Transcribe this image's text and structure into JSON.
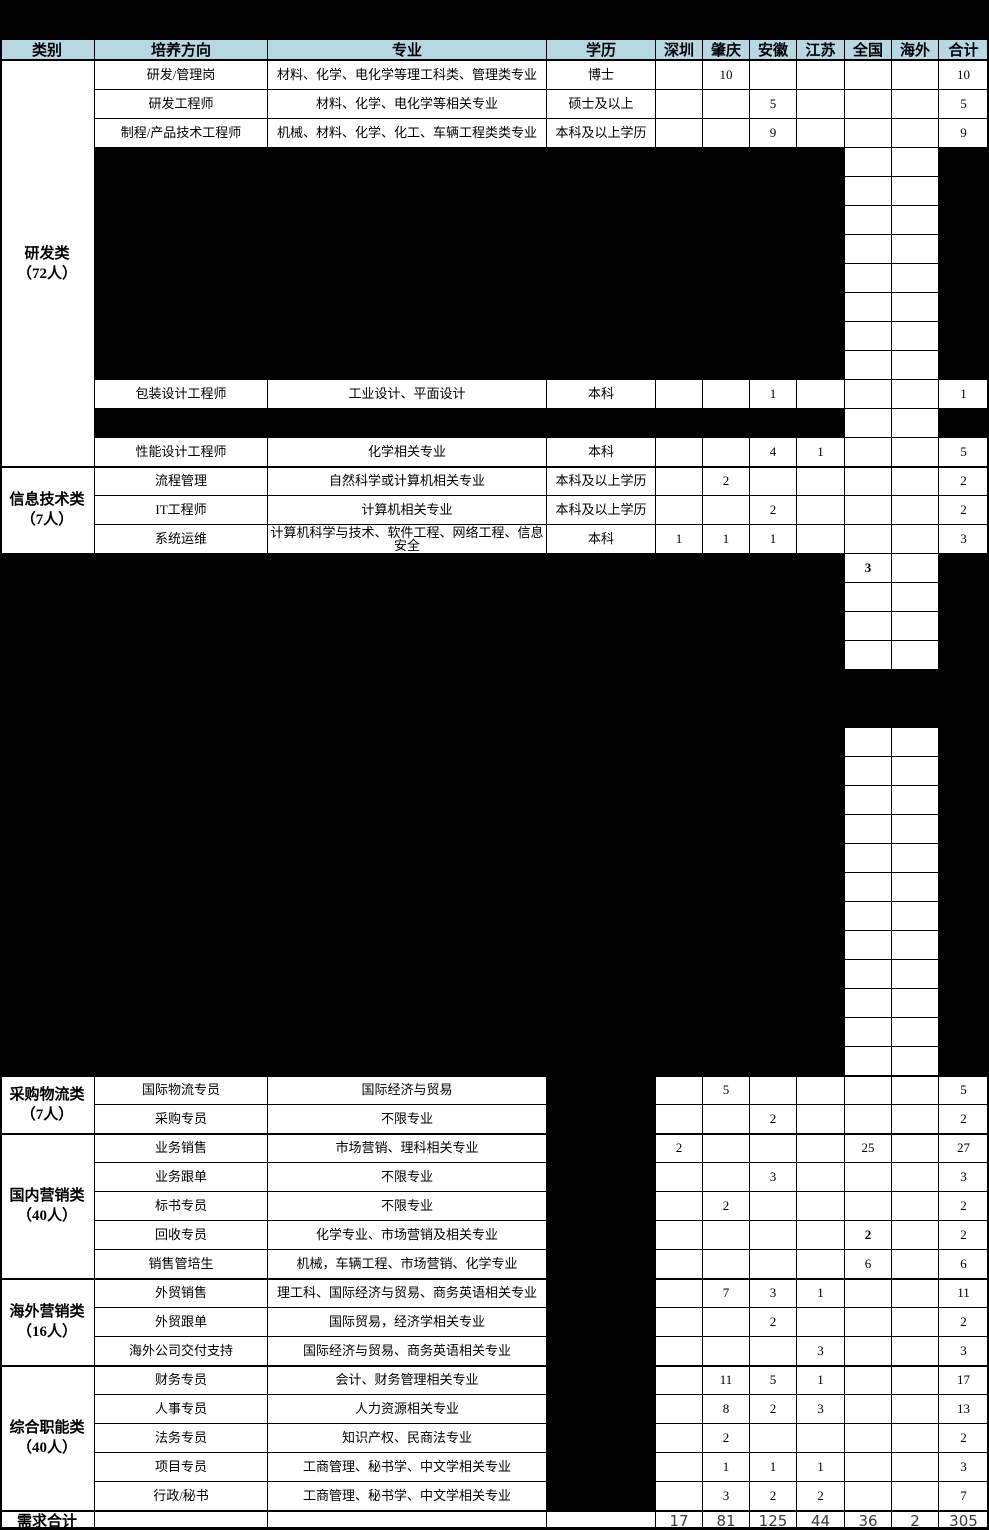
{
  "header": {
    "columns": [
      "类别",
      "培养方向",
      "专业",
      "学历",
      "深圳",
      "肇庆",
      "安徽",
      "江苏",
      "全国",
      "海外",
      "合计"
    ]
  },
  "sections": [
    {
      "category": "研发类\n（72人）",
      "rows": [
        {
          "direction": "研发/管理岗",
          "major": "材料、化学、电化学等理工科类、管理类专业",
          "degree": "博士",
          "values": [
            "",
            "10",
            "",
            "",
            "",
            "",
            "10"
          ]
        },
        {
          "direction": "研发工程师",
          "major": "材料、化学、电化学等相关专业",
          "degree": "硕士及以上",
          "values": [
            "",
            "",
            "5",
            "",
            "",
            "",
            "5"
          ]
        },
        {
          "direction": "制程/产品技术工程师",
          "major": "机械、材料、化学、化工、车辆工程类类专业",
          "degree": "本科及以上学历",
          "values": [
            "",
            "",
            "9",
            "",
            "",
            "",
            "9"
          ]
        },
        {
          "direction": "包装设计工程师",
          "major": "工业设计、平面设计",
          "degree": "本科",
          "values": [
            "",
            "",
            "1",
            "",
            "",
            "",
            "1"
          ]
        },
        {
          "direction": "性能设计工程师",
          "major": "化学相关专业",
          "degree": "本科",
          "values": [
            "",
            "",
            "4",
            "1",
            "",
            "",
            "5"
          ]
        }
      ]
    },
    {
      "category": "信息技术类\n（7人）",
      "rows": [
        {
          "direction": "流程管理",
          "major": "自然科学或计算机相关专业",
          "degree": "本科及以上学历",
          "values": [
            "",
            "2",
            "",
            "",
            "",
            "",
            "2"
          ]
        },
        {
          "direction": "IT工程师",
          "major": "计算机相关专业",
          "degree": "本科及以上学历",
          "values": [
            "",
            "",
            "2",
            "",
            "",
            "",
            "2"
          ]
        },
        {
          "direction": "系统运维",
          "major": "计算机科学与技术、软件工程、网络工程、信息安全",
          "degree": "本科",
          "values": [
            "1",
            "1",
            "1",
            "",
            "",
            "",
            "3"
          ]
        }
      ]
    },
    {
      "category": "采购物流类\n（7人）",
      "rows": [
        {
          "direction": "国际物流专员",
          "major": "国际经济与贸易",
          "degree": "",
          "values": [
            "",
            "5",
            "",
            "",
            "",
            "",
            "5"
          ]
        },
        {
          "direction": "采购专员",
          "major": "不限专业",
          "degree": "",
          "values": [
            "",
            "",
            "2",
            "",
            "",
            "",
            "2"
          ]
        }
      ]
    },
    {
      "category": "国内营销类\n（40人）",
      "rows": [
        {
          "direction": "业务销售",
          "major": "市场营销、理科相关专业",
          "degree": "",
          "values": [
            "2",
            "",
            "",
            "",
            "25",
            "",
            "27"
          ]
        },
        {
          "direction": "业务跟单",
          "major": "不限专业",
          "degree": "",
          "values": [
            "",
            "",
            "3",
            "",
            "",
            "",
            "3"
          ]
        },
        {
          "direction": "标书专员",
          "major": "不限专业",
          "degree": "",
          "values": [
            "",
            "2",
            "",
            "",
            "",
            "",
            "2"
          ]
        },
        {
          "direction": "回收专员",
          "major": "化学专业、市场营销及相关专业",
          "degree": "",
          "values": [
            "",
            "",
            "",
            "",
            "2",
            "",
            "2"
          ],
          "bold_value_cols": [
            4
          ]
        },
        {
          "direction": "销售管培生",
          "major": "机械，车辆工程、市场营销、化学专业",
          "degree": "",
          "values": [
            "",
            "",
            "",
            "",
            "6",
            "",
            "6"
          ]
        }
      ]
    },
    {
      "category": "海外营销类\n（16人）",
      "rows": [
        {
          "direction": "外贸销售",
          "major": "理工科、国际经济与贸易、商务英语相关专业",
          "degree": "",
          "values": [
            "",
            "7",
            "3",
            "1",
            "",
            "",
            "11"
          ]
        },
        {
          "direction": "外贸跟单",
          "major": "国际贸易，经济学相关专业",
          "degree": "",
          "values": [
            "",
            "",
            "2",
            "",
            "",
            "",
            "2"
          ]
        },
        {
          "direction": "海外公司交付支持",
          "major": "国际经济与贸易、商务英语相关专业",
          "degree": "",
          "values": [
            "",
            "",
            "",
            "3",
            "",
            "",
            "3"
          ]
        }
      ]
    },
    {
      "category": "综合职能类\n（40人）",
      "rows": [
        {
          "direction": "财务专员",
          "major": "会计、财务管理相关专业",
          "degree": "",
          "values": [
            "",
            "11",
            "5",
            "1",
            "",
            "",
            "17"
          ]
        },
        {
          "direction": "人事专员",
          "major": "人力资源相关专业",
          "degree": "",
          "values": [
            "",
            "8",
            "2",
            "3",
            "",
            "",
            "13"
          ]
        },
        {
          "direction": "法务专员",
          "major": "知识产权、民商法专业",
          "degree": "",
          "values": [
            "",
            "2",
            "",
            "",
            "",
            "",
            "2"
          ]
        },
        {
          "direction": "项目专员",
          "major": "工商管理、秘书学、中文学相关专业",
          "degree": "",
          "values": [
            "",
            "1",
            "1",
            "1",
            "",
            "",
            "3"
          ]
        },
        {
          "direction": "行政/秘书",
          "major": "工商管理、秘书学、中文学相关专业",
          "degree": "",
          "values": [
            "",
            "3",
            "2",
            "2",
            "",
            "",
            "7"
          ]
        }
      ]
    }
  ],
  "redacted_block_visible_value": {
    "column": "全国",
    "value": "3",
    "bold": true
  },
  "totals": {
    "label": "需求合计",
    "values": [
      "17",
      "81",
      "125",
      "44",
      "36",
      "2",
      "305"
    ]
  },
  "colors": {
    "header_bg": "#b6d8e2",
    "grid": "#000000",
    "redaction": "#000000",
    "totals_text": "#3b3b3b"
  }
}
